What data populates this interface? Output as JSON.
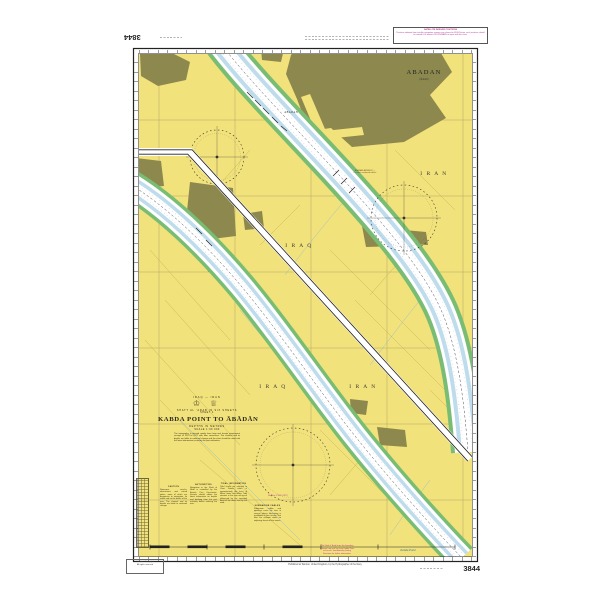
{
  "sheet": {
    "chart_number": "3844",
    "chart_number_top": "3844",
    "imprint": "Published at Taunton, United Kingdom, by the Hydrographer of the Navy",
    "copyright_line1": "© Crown Copyright",
    "copyright_line2": "All rights reserved",
    "corner_note_title": "SATELLITE-DERIVED POSITIONS",
    "corner_note_body": "Positions obtained from satellite navigation systems are referred to WGS Datum; such positions should be moved 0.05 minutes SOUTHWARD to agree with this chart."
  },
  "titleblock": {
    "nations": "IRAQ — IRAN",
    "crests": "♔ ♕",
    "series": "SHATT AL 'ARAB IN SIX SHEETS",
    "sheet_line": "SHEET 4",
    "title": "KABDA POINT TO ĀBĀDĀN",
    "depths": "DEPTHS IN METRES",
    "scale": "SCALE 1:30 000",
    "source_note": "The topography is derived mainly from Iraqi and Iranian government surveys of 1974 to 1977 with later corrections. The channel and its depths are liable to continual change and the chart should be used with the latest information issued by the port authorities."
  },
  "labels": {
    "iraq_upper": "I R A Q",
    "iran_upper": "I R A N",
    "iraq_lower": "I R A Q",
    "iran_lower": "I R A N",
    "city": "ABADAN",
    "city_sub": "(Ābādān)",
    "town": "A B A D A N",
    "water_point": "Kabda Point",
    "airport_note": "ABADAN AIRFIELD — Caution: overhead cables",
    "rose_note": "Mag Var 2°30′E (1977)"
  },
  "notes": [
    {
      "title": "CAUTION",
      "body": "Numerous wrecks, obstructions and ruined jetties, some of which are dangerous to navigation, lie within and on the banks of the river. The channel and its depths are liable to continual change."
    },
    {
      "title": "AUTHORITIES",
      "body": "Navigation in the Shatt al 'Arab is controlled by the Basrah Port Directorate. Vessels should obtain the latest information on depths and berthing from the port authority before entering the river."
    },
    {
      "title": "TIDAL INFORMATION",
      "body": "Tidal levels are referred to Chart Datum, which is approximately the level of Mean Lower Low Water. Tidal streams in the river are much influenced by the seasonal flood of the rivers and by the wind."
    },
    {
      "title": "SUBMARINE CABLES",
      "body": "Submarine cables and pipelines cross the river in several places. Anchoring is prohibited in their vicinity. See also the relevant notes on adjoining sheets of this series."
    }
  ],
  "bottom_note_lines": {
    "l1": "The Shatt al 'Arab forms the boundary",
    "l2": "between Iraq and Iran from Kabda Point",
    "l3": "to the sea. See Admiralty Sailing",
    "l4": "Directions for further information."
  },
  "colors": {
    "land": "#f2e27b",
    "urban": "#8d884e",
    "shallow": "#79bd74",
    "channel": "#bfdcec",
    "magenta": "#b5378f"
  }
}
